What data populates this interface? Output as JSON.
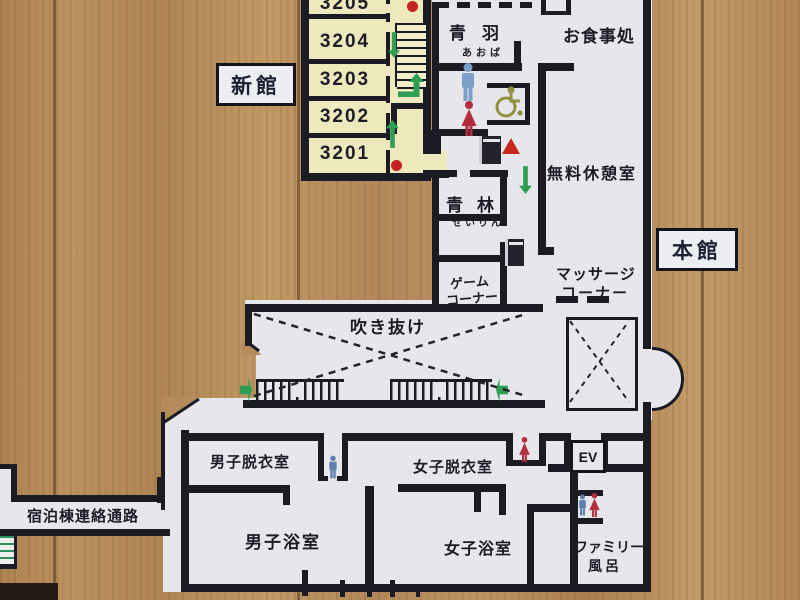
{
  "sign": {
    "building_labels": {
      "new": "新館",
      "main": "本館"
    },
    "rooms": [
      "3205",
      "3204",
      "3203",
      "3202",
      "3201"
    ],
    "areas": {
      "aoba": "青羽",
      "aoba_kana": "あおば",
      "dining": "お食事処",
      "free_rest_room": "無料休憩室",
      "seirin": "青林",
      "seirin_kana": "せいりん",
      "game_line1": "ゲーム",
      "game_line2": "コーナー",
      "massage_line1": "マッサージ",
      "massage_line2": "コーナー",
      "atrium": "吹き抜け",
      "mens_changing": "男子脱衣室",
      "womens_changing": "女子脱衣室",
      "mens_bath": "男子浴室",
      "womens_bath": "女子浴室",
      "family_line1": "ファミリー",
      "family_line2": "風呂",
      "corridor": "宿泊棟連絡通路",
      "elevator": "EV"
    },
    "icons": [
      "mens-toilet-icon",
      "womens-toilet-icon",
      "accessible-toilet-icon",
      "vending-machine-icon",
      "fire-extinguisher-icon",
      "staircase-icon",
      "escalator-icon",
      "exit-dot-icon",
      "route-arrow-icon"
    ],
    "colors": {
      "wood": "#b48a58",
      "plan_background": "#e7e7eb",
      "room_fill": "#eee9bd",
      "wall": "#1b1b24",
      "arrow_green": "#2f9e55",
      "dot_red": "#c32222",
      "man_blue": "#7d9ec6",
      "woman_red": "#b22d3d",
      "wheelchair_olive": "#8f9140"
    }
  }
}
